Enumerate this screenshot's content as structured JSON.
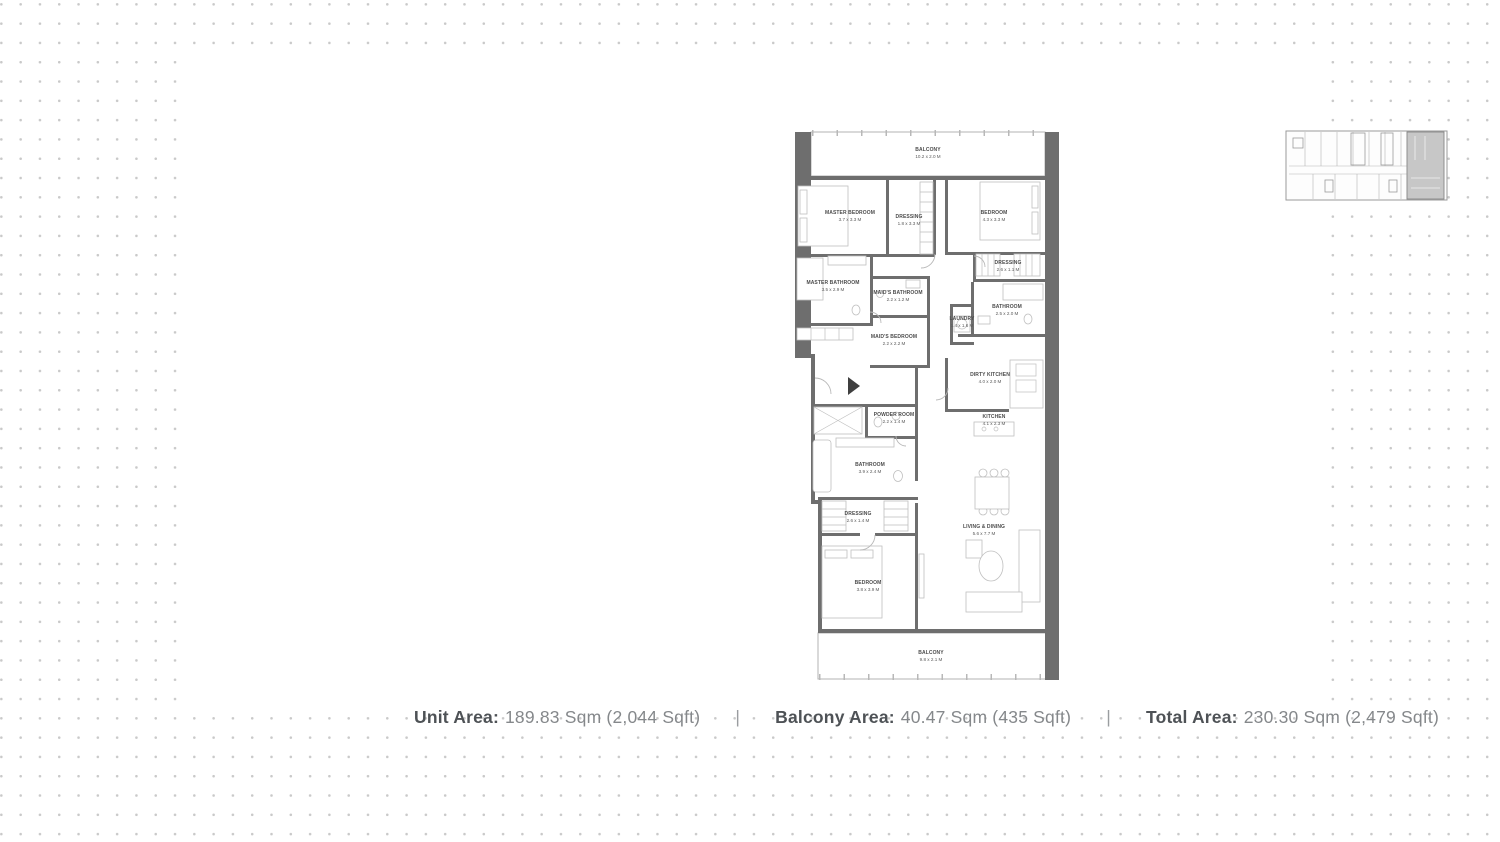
{
  "colors": {
    "wall_gray": "#6e6e6e",
    "dot_gray": "#c9c9c9",
    "keyplan_highlight": "#c7c7c7",
    "label_dark": "#4e5256",
    "label_value": "#85888b"
  },
  "floor_plan": {
    "rooms": [
      {
        "name": "BALCONY",
        "dims": "10.2 x 2.0 M"
      },
      {
        "name": "MASTER BEDROOM",
        "dims": "3.7 x 3.3 M"
      },
      {
        "name": "DRESSING",
        "dims": "1.8 x 3.3 M"
      },
      {
        "name": "BEDROOM",
        "dims": "4.3 x 3.3 M"
      },
      {
        "name": "MASTER BATHROOM",
        "dims": "3.5 x 2.9 M"
      },
      {
        "name": "MAID'S BATHROOM",
        "dims": "2.2 x 1.2 M"
      },
      {
        "name": "MAID'S BEDROOM",
        "dims": "2.2 x 2.2 M"
      },
      {
        "name": "DRESSING",
        "dims": "2.6 x 1.1 M"
      },
      {
        "name": "BATHROOM",
        "dims": "2.5 x 2.0 M"
      },
      {
        "name": "LAUNDRY",
        "dims": "1.4 x 1.6 M"
      },
      {
        "name": "DIRTY KITCHEN",
        "dims": "4.0 x 2.0 M"
      },
      {
        "name": "KITCHEN",
        "dims": "4.1 x 2.3 M"
      },
      {
        "name": "POWDER ROOM",
        "dims": "2.2 x 1.4 M"
      },
      {
        "name": "BATHROOM",
        "dims": "3.9 x 2.4 M"
      },
      {
        "name": "DRESSING",
        "dims": "2.6 x 1.4 M"
      },
      {
        "name": "BEDROOM",
        "dims": "3.8 x 3.9 M"
      },
      {
        "name": "LIVING & DINING",
        "dims": "5.6 x 7.7 M"
      },
      {
        "name": "BALCONY",
        "dims": "9.8 x 2.1 M"
      }
    ]
  },
  "footer": {
    "separator": "|",
    "segments": [
      {
        "label": "Unit Area:",
        "value": "189.83 Sqm (2,044 Sqft)"
      },
      {
        "label": "Balcony Area:",
        "value": "40.47 Sqm (435 Sqft)"
      },
      {
        "label": "Total Area:",
        "value": "230.30 Sqm (2,479 Sqft)"
      }
    ]
  }
}
